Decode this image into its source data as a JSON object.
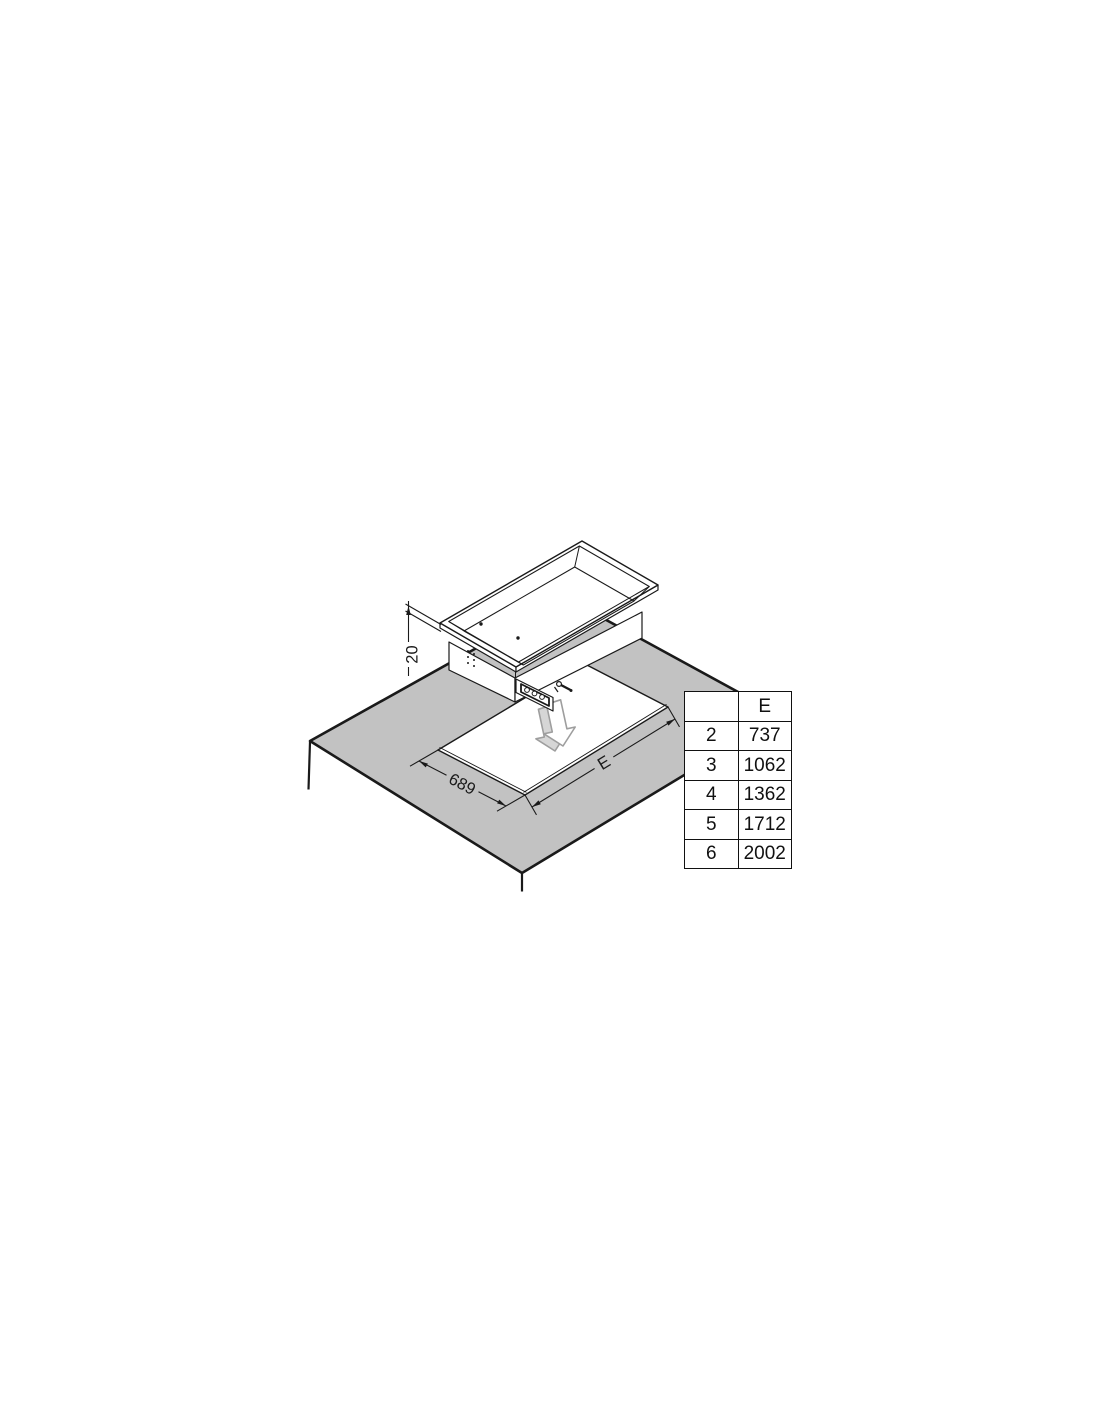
{
  "diagram": {
    "title": "drop-in unit installation cut-out drawing",
    "dimensions": {
      "flange_thickness": "20",
      "cutout_width": "689",
      "cutout_length_label": "E"
    },
    "icons": {
      "insert_arrow": "3d-down-arrow"
    },
    "colors": {
      "background": "#ffffff",
      "line": "#1a1a1a",
      "countertop": "#c2c2c2",
      "arrow_outline": "#9e9e9e",
      "arrow_side": "#d6d6d6"
    }
  },
  "size_table": {
    "headers": [
      "",
      "E"
    ],
    "rows": [
      [
        "2",
        "737"
      ],
      [
        "3",
        "1062"
      ],
      [
        "4",
        "1362"
      ],
      [
        "5",
        "1712"
      ],
      [
        "6",
        "2002"
      ]
    ]
  }
}
